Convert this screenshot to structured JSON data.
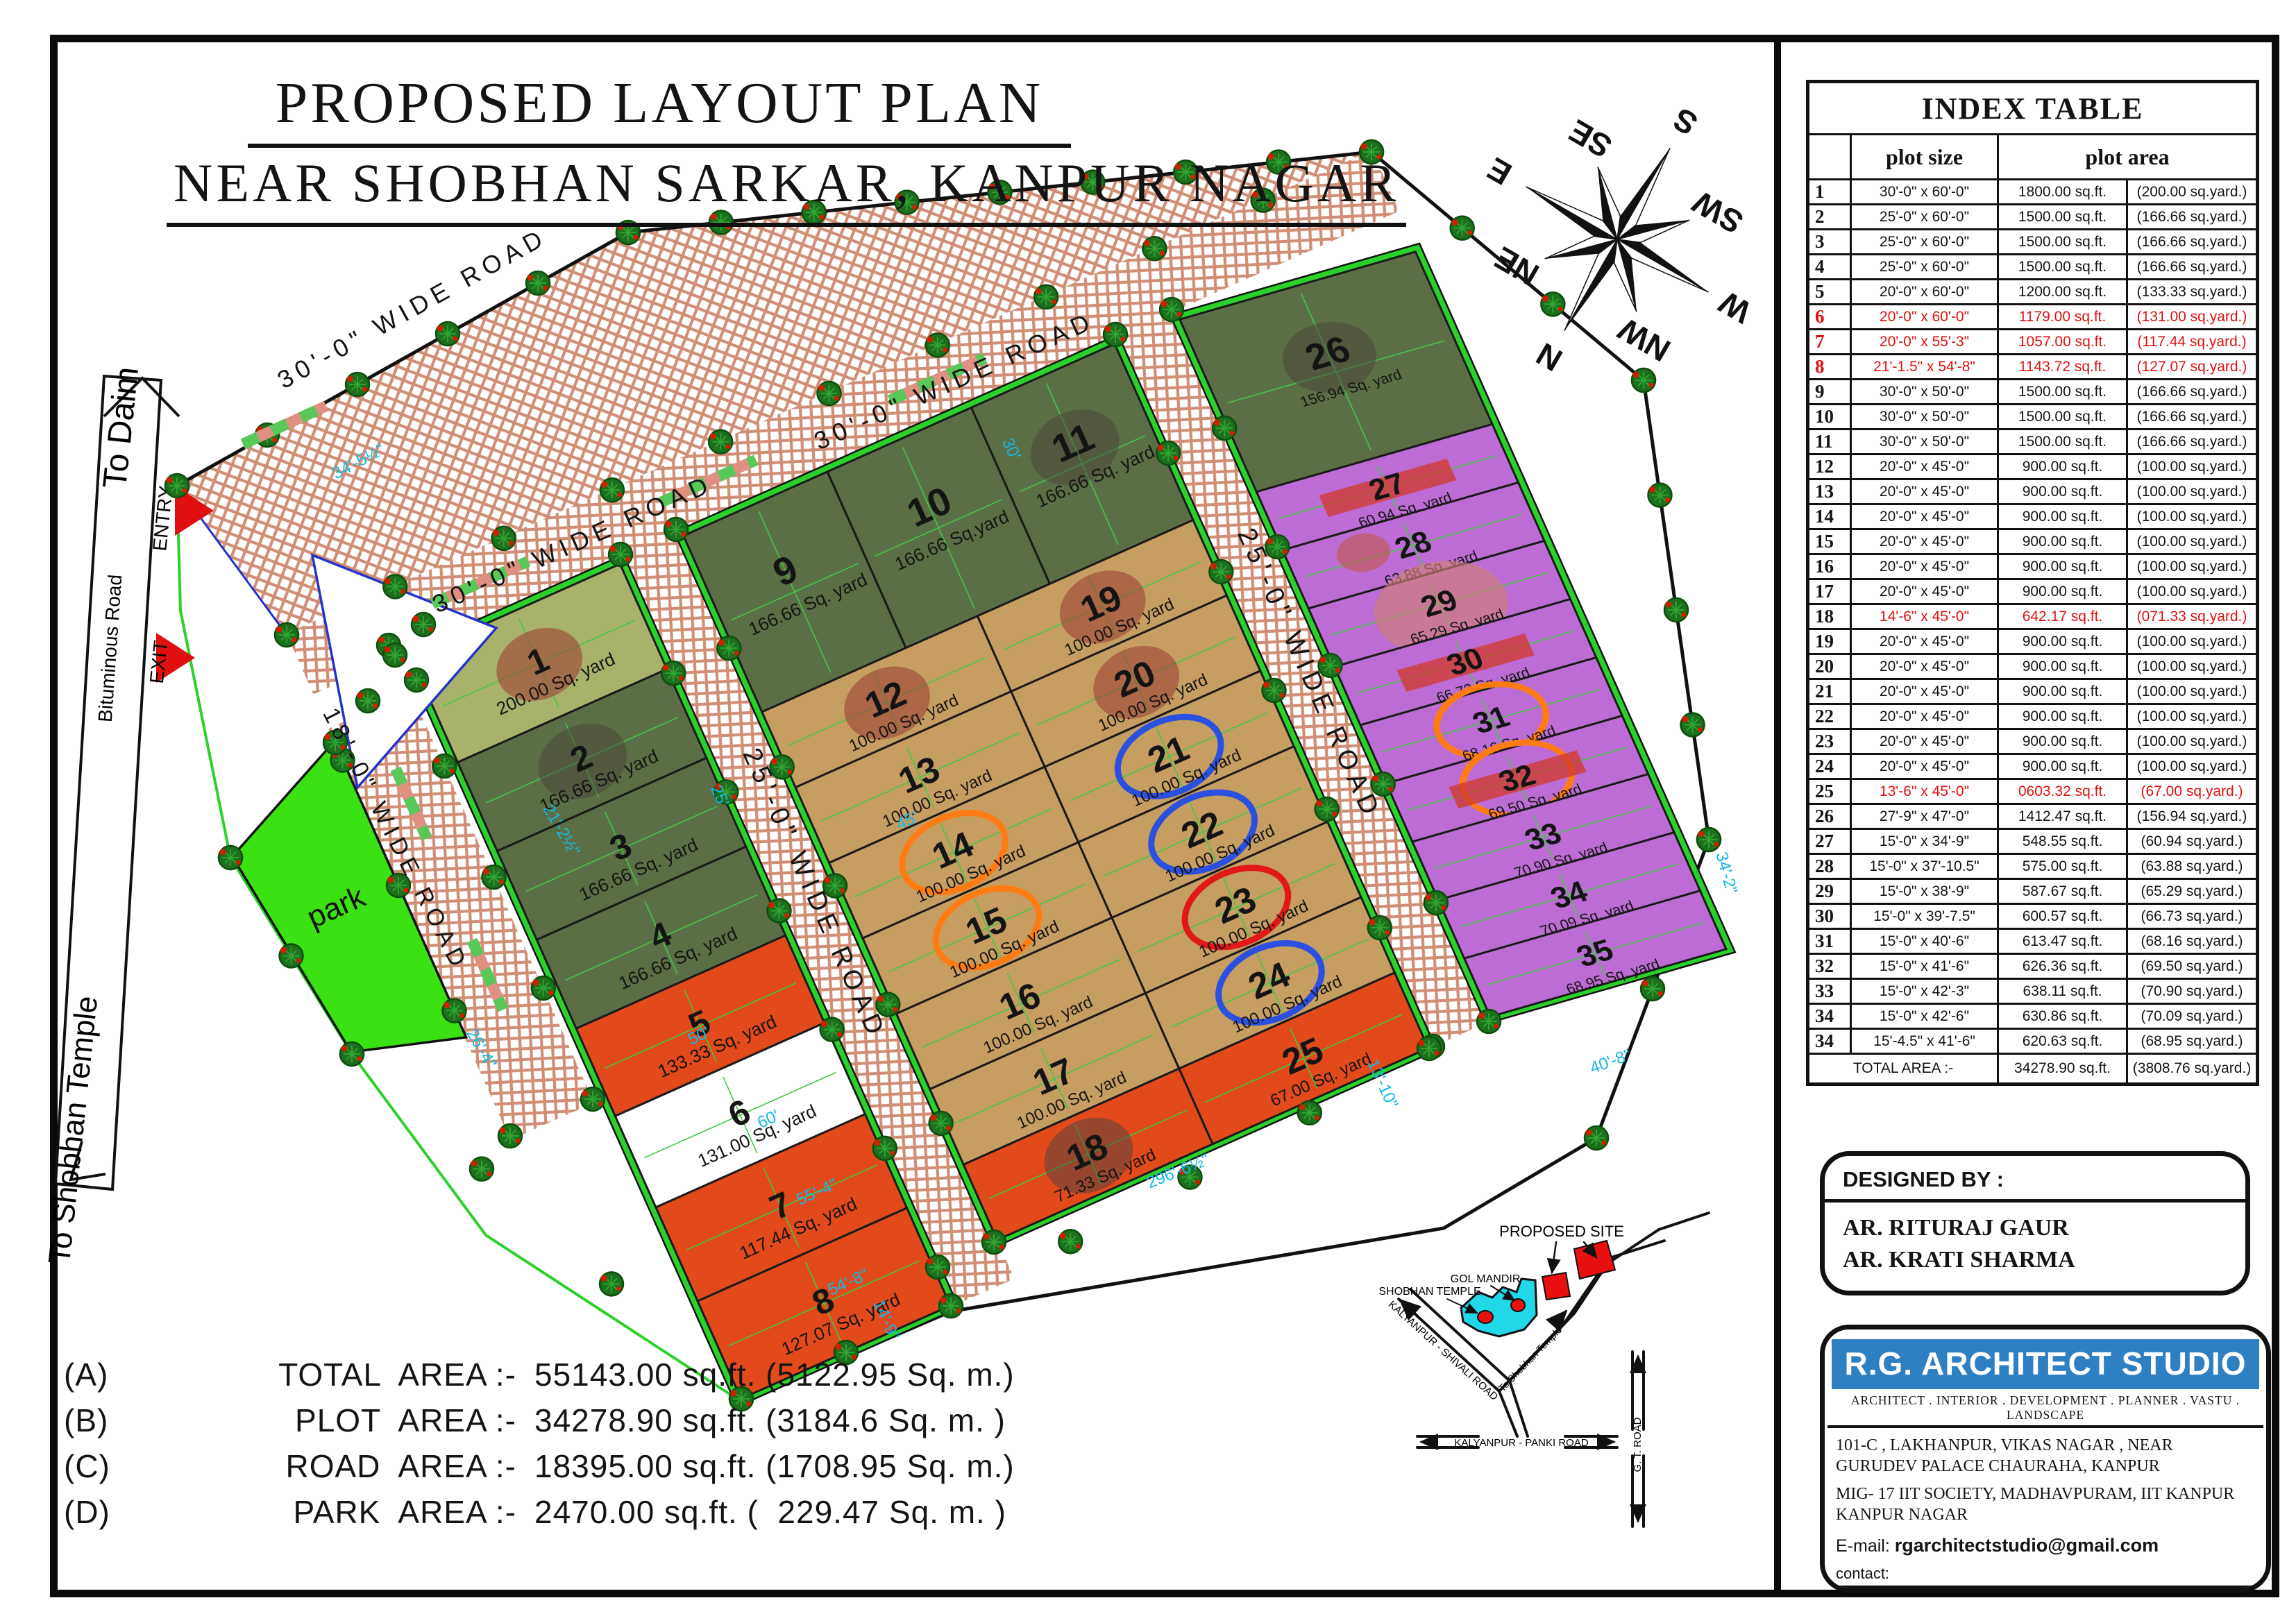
{
  "title": {
    "line1": "PROPOSED LAYOUT PLAN",
    "line2": "NEAR  SHOBHAN SARKAR,  KANPUR NAGAR"
  },
  "area_summary": [
    {
      "key": "(A)",
      "label": "TOTAL  AREA :-",
      "value": "55143.00 sq.ft. (5122.95 Sq. m.)"
    },
    {
      "key": "(B)",
      "label": "PLOT  AREA :-",
      "value": "34278.90 sq.ft. (3184.6 Sq. m. )"
    },
    {
      "key": "(C)",
      "label": "ROAD  AREA :-",
      "value": "18395.00 sq.ft. (1708.95 Sq. m.)"
    },
    {
      "key": "(D)",
      "label": "PARK  AREA :-",
      "value": "2470.00 sq.ft. (  229.47 Sq. m. )"
    }
  ],
  "index_table": {
    "title": "INDEX TABLE",
    "headers": {
      "size": "plot size",
      "area": "plot area"
    },
    "rows": [
      {
        "no": "1",
        "size": "30'-0\" x 60'-0\"",
        "sqft": "1800.00 sq.ft.",
        "yard": "(200.00 sq.yard.)",
        "red": ""
      },
      {
        "no": "2",
        "size": "25'-0\" x 60'-0\"",
        "sqft": "1500.00 sq.ft.",
        "yard": "(166.66 sq.yard.)",
        "red": ""
      },
      {
        "no": "3",
        "size": "25'-0\" x 60'-0\"",
        "sqft": "1500.00 sq.ft.",
        "yard": "(166.66 sq.yard.)",
        "red": ""
      },
      {
        "no": "4",
        "size": "25'-0\" x 60'-0\"",
        "sqft": "1500.00 sq.ft.",
        "yard": "(166.66 sq.yard.)",
        "red": ""
      },
      {
        "no": "5",
        "size": "20'-0\" x 60'-0\"",
        "sqft": "1200.00 sq.ft.",
        "yard": "(133.33 sq.yard.)",
        "red": ""
      },
      {
        "no": "6",
        "size": "20'-0\" x 60'-0\"",
        "sqft": "1179.00 sq.ft.",
        "yard": "(131.00 sq.yard.)",
        "red": "full"
      },
      {
        "no": "7",
        "size": "20'-0\" x 55'-3\"",
        "sqft": "1057.00 sq.ft.",
        "yard": "(117.44 sq.yard.)",
        "red": "full"
      },
      {
        "no": "8",
        "size": "21'-1.5\" x 54'-8\"",
        "sqft": "1143.72 sq.ft.",
        "yard": "(127.07 sq.yard.)",
        "red": "full"
      },
      {
        "no": "9",
        "size": "30'-0\" x 50'-0\"",
        "sqft": "1500.00 sq.ft.",
        "yard": "(166.66 sq.yard.)",
        "red": ""
      },
      {
        "no": "10",
        "size": "30'-0\" x 50'-0\"",
        "sqft": "1500.00 sq.ft.",
        "yard": "(166.66 sq.yard.)",
        "red": ""
      },
      {
        "no": "11",
        "size": "30'-0\" x 50'-0\"",
        "sqft": "1500.00 sq.ft.",
        "yard": "(166.66 sq.yard.)",
        "red": ""
      },
      {
        "no": "12",
        "size": "20'-0\" x 45'-0\"",
        "sqft": "900.00 sq.ft.",
        "yard": "(100.00 sq.yard.)",
        "red": ""
      },
      {
        "no": "13",
        "size": "20'-0\" x 45'-0\"",
        "sqft": "900.00 sq.ft.",
        "yard": "(100.00 sq.yard.)",
        "red": ""
      },
      {
        "no": "14",
        "size": "20'-0\" x 45'-0\"",
        "sqft": "900.00 sq.ft.",
        "yard": "(100.00 sq.yard.)",
        "red": ""
      },
      {
        "no": "15",
        "size": "20'-0\" x 45'-0\"",
        "sqft": "900.00 sq.ft.",
        "yard": "(100.00 sq.yard.)",
        "red": ""
      },
      {
        "no": "16",
        "size": "20'-0\" x 45'-0\"",
        "sqft": "900.00 sq.ft.",
        "yard": "(100.00 sq.yard.)",
        "red": ""
      },
      {
        "no": "17",
        "size": "20'-0\" x 45'-0\"",
        "sqft": "900.00 sq.ft.",
        "yard": "(100.00 sq.yard.)",
        "red": ""
      },
      {
        "no": "18",
        "size": "14'-6\" x 45'-0\"",
        "sqft": "642.17 sq.ft.",
        "yard": "(071.33 sq.yard.)",
        "red": "vals"
      },
      {
        "no": "19",
        "size": "20'-0\" x 45'-0\"",
        "sqft": "900.00 sq.ft.",
        "yard": "(100.00 sq.yard.)",
        "red": ""
      },
      {
        "no": "20",
        "size": "20'-0\" x 45'-0\"",
        "sqft": "900.00 sq.ft.",
        "yard": "(100.00 sq.yard.)",
        "red": ""
      },
      {
        "no": "21",
        "size": "20'-0\" x 45'-0\"",
        "sqft": "900.00 sq.ft.",
        "yard": "(100.00 sq.yard.)",
        "red": ""
      },
      {
        "no": "22",
        "size": "20'-0\" x 45'-0\"",
        "sqft": "900.00 sq.ft.",
        "yard": "(100.00 sq.yard.)",
        "red": ""
      },
      {
        "no": "23",
        "size": "20'-0\" x 45'-0\"",
        "sqft": "900.00 sq.ft.",
        "yard": "(100.00 sq.yard.)",
        "red": ""
      },
      {
        "no": "24",
        "size": "20'-0\" x 45'-0\"",
        "sqft": "900.00 sq.ft.",
        "yard": "(100.00 sq.yard.)",
        "red": ""
      },
      {
        "no": "25",
        "size": "13'-6\" x 45'-0\"",
        "sqft": "0603.32 sq.ft.",
        "yard": "(67.00 sq.yard.)",
        "red": "vals"
      },
      {
        "no": "26",
        "size": "27'-9\" x 47'-0\"",
        "sqft": "1412.47 sq.ft.",
        "yard": "(156.94 sq.yard.)",
        "red": ""
      },
      {
        "no": "27",
        "size": "15'-0\" x 34'-9\"",
        "sqft": "548.55 sq.ft.",
        "yard": "(60.94 sq.yard.)",
        "red": ""
      },
      {
        "no": "28",
        "size": "15'-0\" x 37'-10.5\"",
        "sqft": "575.00 sq.ft.",
        "yard": "(63.88 sq.yard.)",
        "red": ""
      },
      {
        "no": "29",
        "size": "15'-0\" x 38'-9\"",
        "sqft": "587.67 sq.ft.",
        "yard": "(65.29 sq.yard.)",
        "red": ""
      },
      {
        "no": "30",
        "size": "15'-0\" x 39'-7.5\"",
        "sqft": "600.57 sq.ft.",
        "yard": "(66.73 sq.yard.)",
        "red": ""
      },
      {
        "no": "31",
        "size": "15'-0\" x 40'-6\"",
        "sqft": "613.47 sq.ft.",
        "yard": "(68.16 sq.yard.)",
        "red": ""
      },
      {
        "no": "32",
        "size": "15'-0\" x 41'-6\"",
        "sqft": "626.36 sq.ft.",
        "yard": "(69.50 sq.yard.)",
        "red": ""
      },
      {
        "no": "33",
        "size": "15'-0\" x 42'-3\"",
        "sqft": "638.11 sq.ft.",
        "yard": "(70.90 sq.yard.)",
        "red": ""
      },
      {
        "no": "34",
        "size": "15'-0\" x 42'-6\"",
        "sqft": "630.86 sq.ft.",
        "yard": "(70.09 sq.yard.)",
        "red": ""
      },
      {
        "no": "34",
        "size": "15'-4.5\" x 41'-6\"",
        "sqft": "620.63 sq.ft.",
        "yard": "(68.95 sq.yard.)",
        "red": ""
      }
    ],
    "total": {
      "label": "TOTAL AREA :-",
      "sqft": "34278.90 sq.ft.",
      "yard": "(3808.76 sq.yard.)"
    }
  },
  "designed_by": {
    "title": "DESIGNED BY :",
    "names": [
      "AR. RITURAJ GAUR",
      "AR. KRATI SHARMA"
    ]
  },
  "studio": {
    "name": "R.G. ARCHITECT STUDIO",
    "tagline": "ARCHITECT . INTERIOR . DEVELOPMENT . PLANNER . VASTU . LANDSCAPE",
    "address1": "101-C , LAKHANPUR, VIKAS NAGAR , NEAR GURUDEV PALACE CHAURAHA, KANPUR",
    "address2": "MIG- 17 IIT SOCIETY, MADHAVPURAM, IIT KANPUR KANPUR NAGAR",
    "email_label": "E-mail:",
    "email": "rgarchitectstudio@gmail.com",
    "contact_label": "contact:",
    "phones": [
      "+91- 7860211343",
      "+91- 8317008218"
    ]
  },
  "compass": {
    "labels": [
      "N",
      "NE",
      "E",
      "SE",
      "S",
      "SW",
      "W",
      "NW"
    ]
  },
  "plan": {
    "park_label": "park",
    "labels": {
      "to_daim": "To Daim",
      "entry": "ENTRY",
      "exit": "EXIT",
      "bituminous": "Bituminous Road",
      "to_shobhan": "To Shobhan Temple"
    },
    "road_labels": [
      {
        "t": "30'-0\" WIDE ROAD"
      },
      {
        "t": "30'-0\" WIDE ROAD"
      },
      {
        "t": "30'-0\" WIDE ROAD"
      },
      {
        "t": "25'-0\" WIDE ROAD"
      },
      {
        "t": "25'-0\" WIDE ROAD"
      },
      {
        "t": "18'-0\" WIDE ROAD"
      }
    ],
    "dims": [
      {
        "t": "34'-5½\""
      },
      {
        "t": "30'"
      },
      {
        "t": "25'"
      },
      {
        "t": "45'"
      },
      {
        "t": "50'"
      },
      {
        "t": "60'"
      },
      {
        "t": "55'-4\""
      },
      {
        "t": "54'-8\""
      },
      {
        "t": "13'-10\""
      },
      {
        "t": "14'-9\""
      },
      {
        "t": "26'-4\""
      },
      {
        "t": "21'-2½\""
      },
      {
        "t": "296'-6½\""
      },
      {
        "t": "40'-8\""
      },
      {
        "t": "34'-2\""
      }
    ],
    "plots": [
      {
        "no": "1",
        "area": "200.00 Sq. yard",
        "color": "lightolive",
        "mark": "blob-red"
      },
      {
        "no": "2",
        "area": "166.66 Sq. yard",
        "color": "olive",
        "mark": "blob-gray"
      },
      {
        "no": "3",
        "area": "166.66 Sq. yard",
        "color": "olive",
        "mark": ""
      },
      {
        "no": "4",
        "area": "166.66 Sq. yard",
        "color": "olive",
        "mark": ""
      },
      {
        "no": "5",
        "area": "133.33 Sq. yard",
        "color": "orange",
        "mark": ""
      },
      {
        "no": "6",
        "area": "131.00 Sq. yard",
        "color": "white",
        "mark": ""
      },
      {
        "no": "7",
        "area": "117.44 Sq. yard",
        "color": "orange",
        "mark": ""
      },
      {
        "no": "8",
        "area": "127.07 Sq. yard",
        "color": "orange",
        "mark": ""
      },
      {
        "no": "9",
        "area": "166.66 Sq. yard",
        "color": "olive",
        "mark": ""
      },
      {
        "no": "10",
        "area": "166.66 Sq.yard",
        "color": "olive",
        "mark": ""
      },
      {
        "no": "11",
        "area": "166.66 Sq. yard",
        "color": "olive",
        "mark": "blob-gray"
      },
      {
        "no": "12",
        "area": "100.00 Sq. yard",
        "color": "tan",
        "mark": "blob-red"
      },
      {
        "no": "13",
        "area": "100.00 Sq. yard",
        "color": "tan",
        "mark": ""
      },
      {
        "no": "14",
        "area": "100.00 Sq. yard",
        "color": "tan",
        "mark": "circle-orange"
      },
      {
        "no": "15",
        "area": "100.00 Sq. yard",
        "color": "tan",
        "mark": "circle-orange"
      },
      {
        "no": "16",
        "area": "100.00 Sq. yard",
        "color": "tan",
        "mark": ""
      },
      {
        "no": "17",
        "area": "100.00 Sq. yard",
        "color": "tan",
        "mark": ""
      },
      {
        "no": "18",
        "area": "71.33 Sq. yard",
        "color": "orange",
        "mark": "blob-gray"
      },
      {
        "no": "19",
        "area": "100.00 Sq. yard",
        "color": "tan",
        "mark": "blob-red"
      },
      {
        "no": "20",
        "area": "100.00 Sq. yard",
        "color": "tan",
        "mark": "blob-red"
      },
      {
        "no": "21",
        "area": "100.00 Sq. yard",
        "color": "tan",
        "mark": "circle-blue"
      },
      {
        "no": "22",
        "area": "100.00 Sq. yard",
        "color": "tan",
        "mark": "circle-blue"
      },
      {
        "no": "23",
        "area": "100.00 Sq. yard",
        "color": "tan",
        "mark": "circle-red"
      },
      {
        "no": "24",
        "area": "100.00 Sq. yard",
        "color": "tan",
        "mark": "circle-blue"
      },
      {
        "no": "25",
        "area": "67.00 Sq. yard",
        "color": "orange",
        "mark": ""
      },
      {
        "no": "26",
        "area": "156.94 Sq. yard",
        "color": "olive",
        "mark": "blob-gray"
      },
      {
        "no": "27",
        "area": "60.94 Sq. yard",
        "color": "purple",
        "mark": "hatch"
      },
      {
        "no": "28",
        "area": "63.88 Sq. yard",
        "color": "purple",
        "mark": "blob-small"
      },
      {
        "no": "29",
        "area": "65.29 Sq. yard",
        "color": "purple",
        "mark": "blob-lightred"
      },
      {
        "no": "30",
        "area": "66.73 Sq. yard",
        "color": "purple",
        "mark": "hatch"
      },
      {
        "no": "31",
        "area": "68.16 Sq. yard",
        "color": "purple",
        "mark": "circle-orange"
      },
      {
        "no": "32",
        "area": "69.50 Sq. yard",
        "color": "purple",
        "mark": "circle-orange hatch"
      },
      {
        "no": "33",
        "area": "70.90 Sq. yard",
        "color": "purple",
        "mark": ""
      },
      {
        "no": "34",
        "area": "70.09 Sq. yard",
        "color": "purple",
        "mark": ""
      },
      {
        "no": "35",
        "area": "68.95 Sq. yard",
        "color": "purple",
        "mark": ""
      }
    ],
    "keymap": {
      "proposed_site": "PROPOSED SITE",
      "gol_mandir": "GOL MANDIR",
      "shobhan_temple": "SHOBHAN TEMPLE",
      "road1": "KALYANPUR - SHIVALI ROAD",
      "road2": "To Shobhan Temple",
      "road3": "KALYANPUR - PANKI ROAD",
      "road4": "G. T. ROAD"
    }
  },
  "colors": {
    "plot_fills": {
      "olive": "#5c6e45",
      "lightolive": "#a9b26b",
      "tan": "#c79e62",
      "orange": "#e2491b",
      "white": "#ffffff",
      "purple": "#bd6cd6"
    },
    "park": "#3ae214",
    "verge": "#2bd12b",
    "herringbone": "#d18e75",
    "dim_cyan": "#14b8e6",
    "mark_blue": "#2b50e0",
    "mark_red": "#e01818",
    "mark_orange": "#ff7c14",
    "banner_blue": "#2f80c3",
    "highlight_red": "#e01010"
  }
}
